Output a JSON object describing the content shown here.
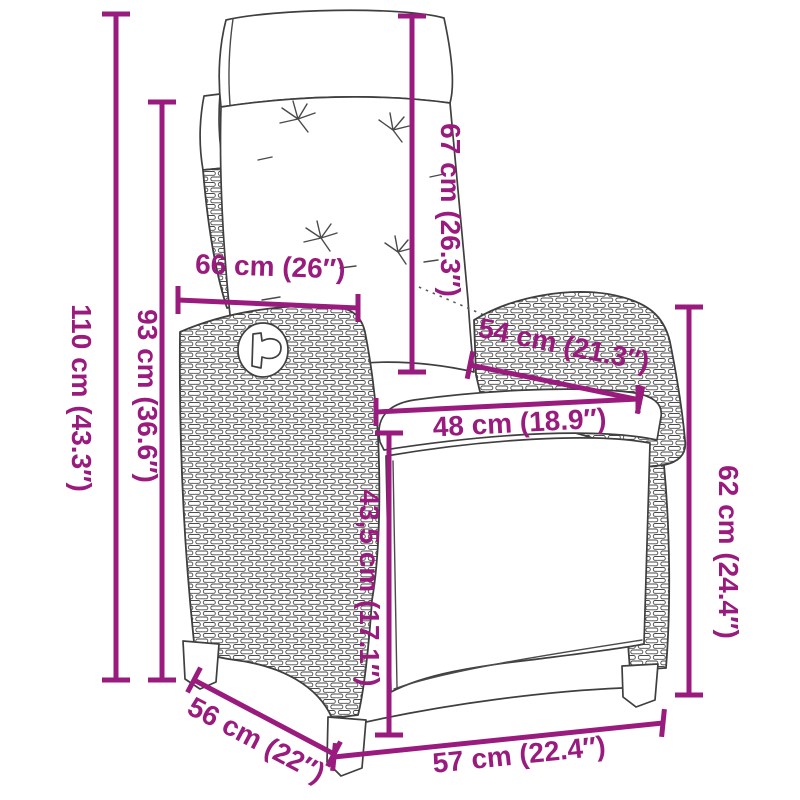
{
  "diagram": {
    "subject": "Reclining rattan garden chair with cushions - dimension drawing",
    "unit_primary": "cm",
    "unit_secondary": "inches",
    "accent_color": "#9A1B7E",
    "outline_color": "#3F3F3F",
    "background_color": "#FFFFFF",
    "dimensions": [
      {
        "name": "total-height",
        "cm": "110",
        "in": "43.3",
        "label": "110 cm (43.3″)"
      },
      {
        "name": "backrest-height",
        "cm": "93",
        "in": "36.6",
        "label": "93 cm (36.6″)"
      },
      {
        "name": "back-cushion-height",
        "cm": "67",
        "in": "26.3",
        "label": "67 cm (26.3″)"
      },
      {
        "name": "backrest-width",
        "cm": "66",
        "in": "26",
        "label": "66 cm (26″)"
      },
      {
        "name": "armrest-length",
        "cm": "54",
        "in": "21.3",
        "label": "54 cm (21.3″)"
      },
      {
        "name": "seat-width",
        "cm": "48",
        "in": "18.9",
        "label": "48 cm (18.9″)"
      },
      {
        "name": "seat-height",
        "cm": "43,5",
        "in": "17.1",
        "label": "43,5 cm (17.1″)"
      },
      {
        "name": "armrest-height",
        "cm": "62",
        "in": "24.4",
        "label": "62 cm (24.4″)"
      },
      {
        "name": "base-depth",
        "cm": "56",
        "in": "22",
        "label": "56 cm (22″)"
      },
      {
        "name": "base-width",
        "cm": "57",
        "in": "22.4",
        "label": "57 cm (22.4″)"
      }
    ]
  }
}
